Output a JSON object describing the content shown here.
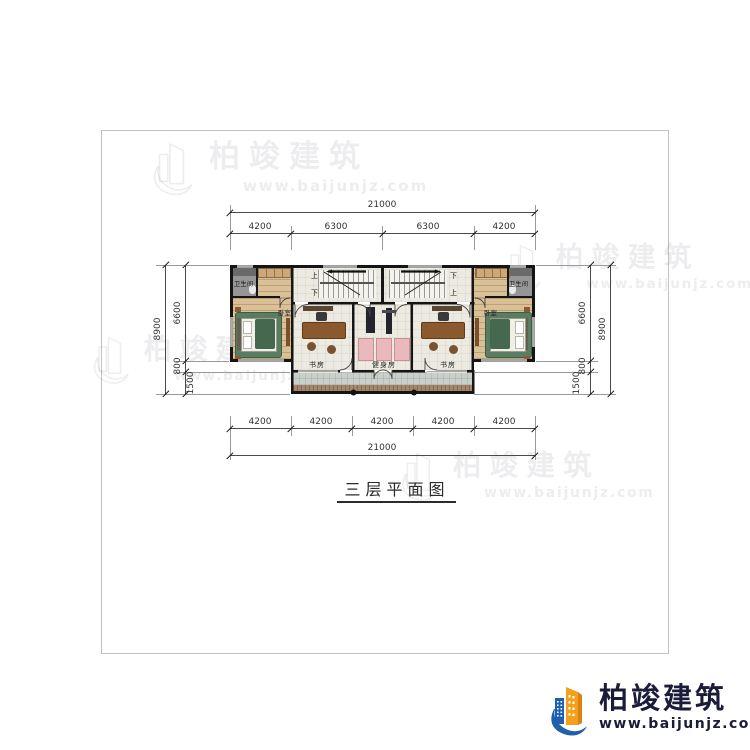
{
  "page": {
    "title_text": "三层平面图"
  },
  "watermark": {
    "brand": "柏竣建筑",
    "url": "www.baijunjz.com"
  },
  "logo": {
    "brand": "柏竣建筑",
    "url": "www.baijunjz.com",
    "colors": {
      "blue": "#1f5fae",
      "orange": "#f5a01d",
      "text": "#1b1b3a"
    }
  },
  "plan": {
    "rooms": {
      "bath_left": "卫生间",
      "bath_right": "卫生间",
      "bed_left": "卧室",
      "bed_right": "卧室",
      "study_left": "书房",
      "study_right": "书房",
      "gym": "健身房"
    },
    "stairs": {
      "up": "上",
      "down": "下"
    }
  },
  "dims": {
    "top": {
      "total": "21000",
      "segments": [
        "4200",
        "6300",
        "6300",
        "4200"
      ]
    },
    "bottom": {
      "total": "21000",
      "segments": [
        "4200",
        "4200",
        "4200",
        "4200",
        "4200"
      ]
    },
    "left": {
      "total": "8900",
      "segments": [
        "6600",
        "800",
        "1500"
      ]
    },
    "right": {
      "total": "8900",
      "segments": [
        "6600",
        "800",
        "1500"
      ]
    }
  }
}
